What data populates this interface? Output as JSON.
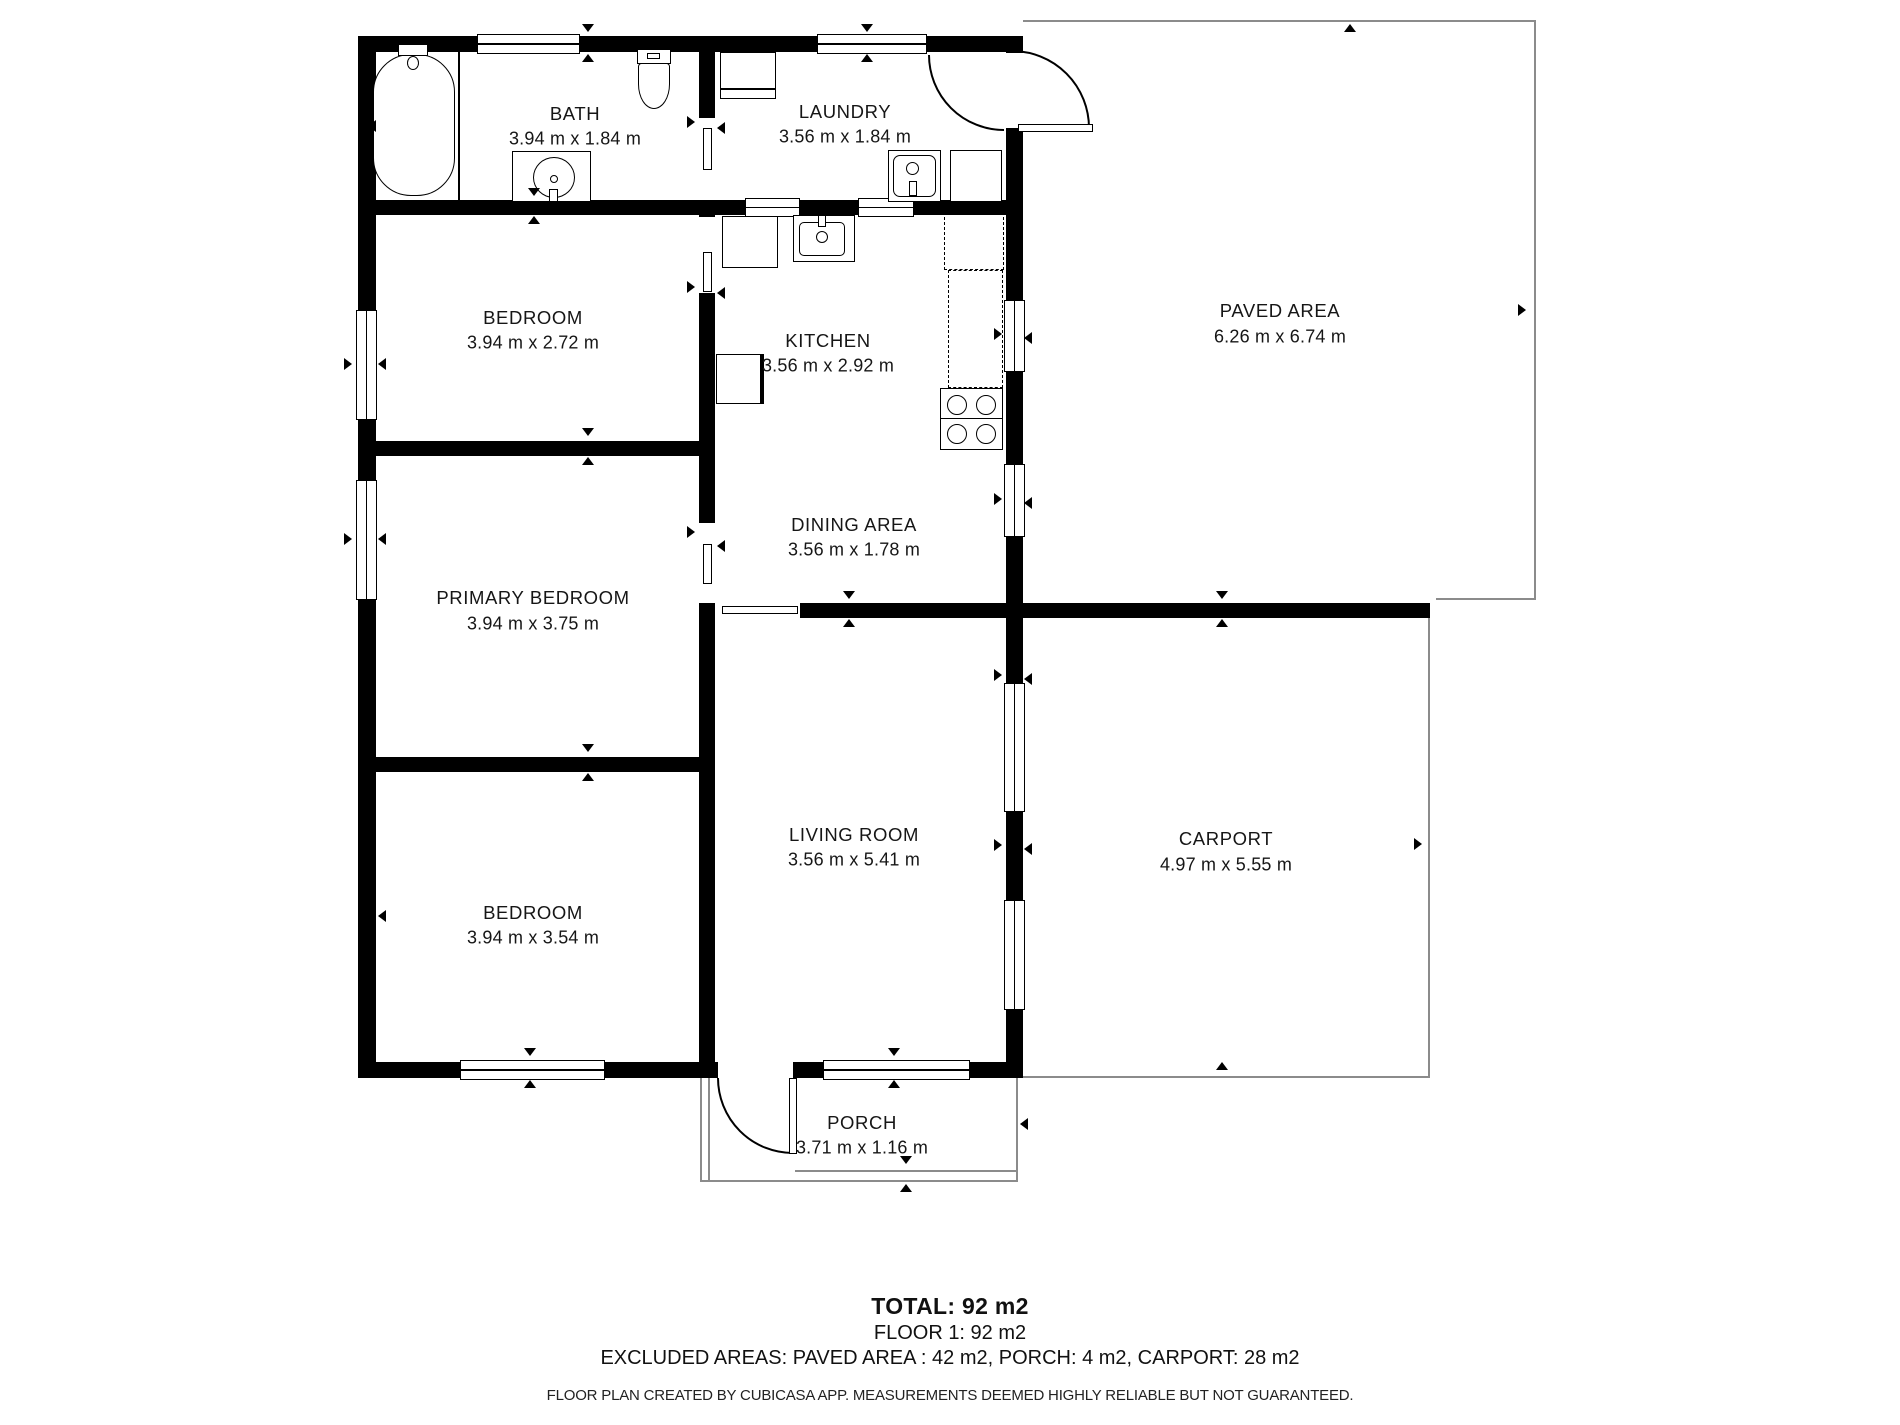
{
  "plan": {
    "rooms": [
      {
        "id": "bath",
        "name": "BATH",
        "dims": "3.94 m x 1.84 m"
      },
      {
        "id": "laundry",
        "name": "LAUNDRY",
        "dims": "3.56 m x 1.84 m"
      },
      {
        "id": "bedroom1",
        "name": "BEDROOM",
        "dims": "3.94 m x 2.72 m"
      },
      {
        "id": "kitchen",
        "name": "KITCHEN",
        "dims": "3.56 m x 2.92 m"
      },
      {
        "id": "paved",
        "name": "PAVED AREA",
        "dims": "6.26 m x 6.74 m"
      },
      {
        "id": "primary",
        "name": "PRIMARY BEDROOM",
        "dims": "3.94 m x 3.75 m"
      },
      {
        "id": "dining",
        "name": "DINING AREA",
        "dims": "3.56 m x 1.78 m"
      },
      {
        "id": "bedroom2",
        "name": "BEDROOM",
        "dims": "3.94 m x 3.54 m"
      },
      {
        "id": "living",
        "name": "LIVING ROOM",
        "dims": "3.56 m x 5.41 m"
      },
      {
        "id": "carport",
        "name": "CARPORT",
        "dims": "4.97 m x 5.55 m"
      },
      {
        "id": "porch",
        "name": "PORCH",
        "dims": "3.71 m x 1.16 m"
      }
    ],
    "footer": {
      "total": "TOTAL: 92 m2",
      "floor": "FLOOR 1: 92 m2",
      "excluded": "EXCLUDED AREAS:   PAVED AREA : 42 m2, PORCH: 4 m2, CARPORT: 28 m2",
      "disclaimer": "FLOOR PLAN CREATED BY CUBICASA APP. MEASUREMENTS DEEMED HIGHLY RELIABLE BUT NOT GUARANTEED."
    }
  }
}
